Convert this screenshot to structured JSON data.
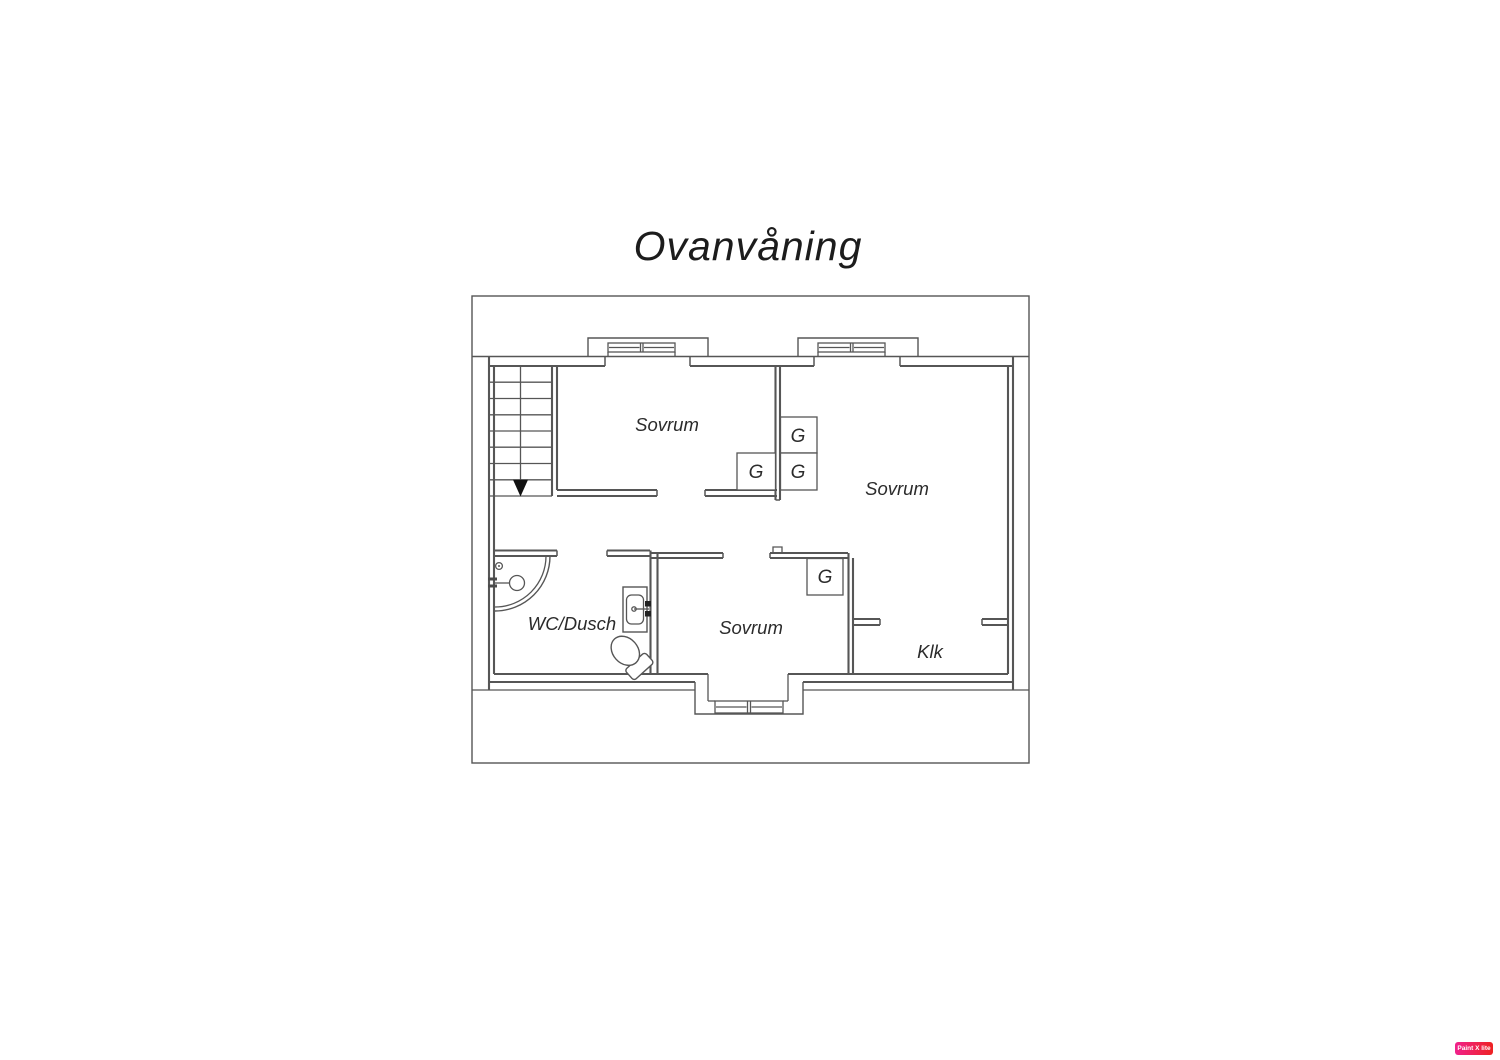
{
  "title": "Ovanvåning",
  "rooms": [
    {
      "id": "bedroom-1",
      "label": "Sovrum"
    },
    {
      "id": "bedroom-2",
      "label": "Sovrum"
    },
    {
      "id": "bedroom-3",
      "label": "Sovrum"
    },
    {
      "id": "wc-dusch",
      "label": "WC/Dusch"
    },
    {
      "id": "klk",
      "label": "Klk"
    }
  ],
  "wardrobe": {
    "label": "G",
    "count": 4
  },
  "icons": {
    "stairs_arrow": "stairs-down-arrow",
    "windows": "double-casement-window-symbol",
    "fixtures": [
      "corner-shower",
      "sink",
      "toilet"
    ]
  },
  "colors": {
    "line": "#565656",
    "text": "#2b2b2b",
    "arrow": "#111111",
    "watermark_start": "#f0218c",
    "watermark_end": "#ee2222"
  },
  "watermark": {
    "label": "Paint X lite"
  }
}
